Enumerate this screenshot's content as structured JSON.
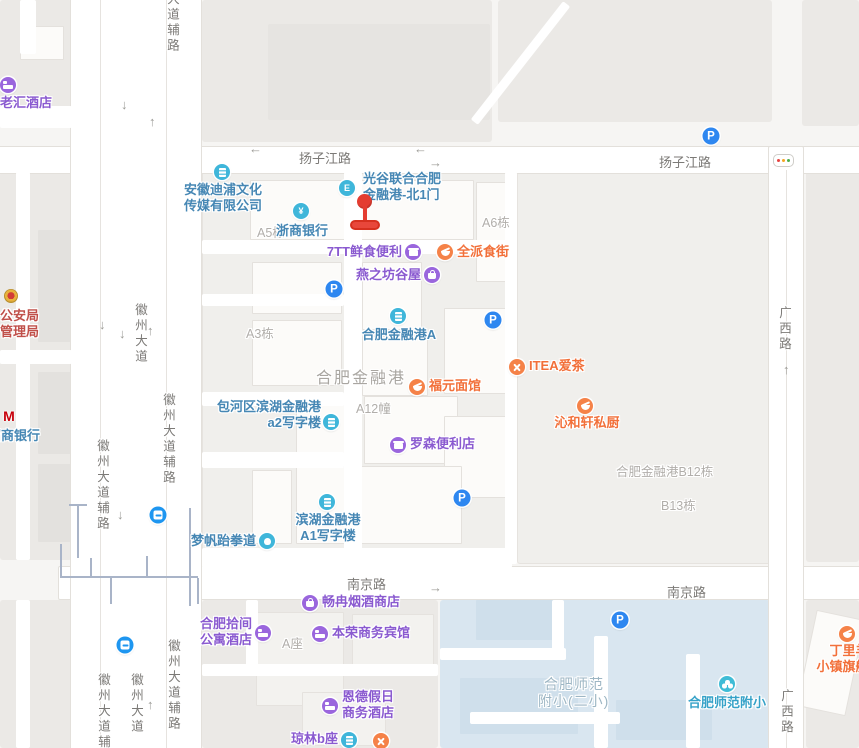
{
  "map": {
    "selected_poi": "光谷联合合肥金融港-北1门",
    "colors": {
      "land": "#f6f5f3",
      "block": "#ebe9e6",
      "campus": "#f0efec",
      "school_area": "#d9e6f0",
      "road": "#ffffff",
      "poi_purple": "#8a5ad0",
      "poi_orange": "#f2703a",
      "poi_blue": "#4687b4",
      "poi_edu": "#36a2c8",
      "parking_blue": "#2e87f0",
      "transit_blue": "#1e96f0",
      "marker_red": "#e43d31",
      "police_red": "#c0504a"
    },
    "road_labels": [
      {
        "text": "扬子江路",
        "x": 299,
        "y": 148,
        "v": false
      },
      {
        "text": "扬子江路",
        "x": 659,
        "y": 152,
        "v": false
      },
      {
        "text": "南京路",
        "x": 347,
        "y": 574,
        "v": false
      },
      {
        "text": "南京路",
        "x": 667,
        "y": 582,
        "v": false
      },
      {
        "text": "大道辅路",
        "x": 163,
        "y": -8,
        "v": true
      },
      {
        "text": "徽州大道",
        "x": 131,
        "y": 303,
        "v": true
      },
      {
        "text": "徽州大道辅路",
        "x": 159,
        "y": 393,
        "v": true
      },
      {
        "text": "徽州大道辅路",
        "x": 93,
        "y": 439,
        "v": true
      },
      {
        "text": "徽州大道辅路",
        "x": 164,
        "y": 639,
        "v": true
      },
      {
        "text": "徽州大道",
        "x": 127,
        "y": 673,
        "v": true
      },
      {
        "text": "徽州大道辅路",
        "x": 94,
        "y": 673,
        "v": true
      },
      {
        "text": "广西路",
        "x": 775,
        "y": 306,
        "v": true
      },
      {
        "text": "广西路",
        "x": 777,
        "y": 689,
        "v": true
      }
    ],
    "area_labels": [
      {
        "text": "A5栋",
        "x": 257,
        "y": 222,
        "cls": ""
      },
      {
        "text": "A6栋",
        "x": 482,
        "y": 212,
        "cls": ""
      },
      {
        "text": "A3栋",
        "x": 246,
        "y": 323,
        "cls": ""
      },
      {
        "text": "合肥金融港",
        "x": 316,
        "y": 364,
        "cls": "big"
      },
      {
        "text": "A12幢",
        "x": 356,
        "y": 398,
        "cls": ""
      },
      {
        "text": "合肥金融港B12栋",
        "x": 616,
        "y": 461,
        "cls": ""
      },
      {
        "text": "B13栋",
        "x": 661,
        "y": 495,
        "cls": ""
      },
      {
        "text": "A座",
        "x": 282,
        "y": 633,
        "cls": ""
      },
      {
        "text": "合肥师范",
        "x": 544,
        "y": 674,
        "cls": "edu"
      },
      {
        "text": "附小(二小)",
        "x": 538,
        "y": 691,
        "cls": "edu"
      }
    ],
    "pois": [
      {
        "lines": [
          "老汇酒店"
        ],
        "cat": "purple",
        "icon": "hotel-icon",
        "ix": 8,
        "iy": 85,
        "lx": 26,
        "ly": 95,
        "align": "c"
      },
      {
        "lines": [
          "安徽迪浦文化",
          "传媒有限公司"
        ],
        "cat": "blue",
        "icon": "company-building-icon",
        "ix": 222,
        "iy": 172,
        "lx": 223,
        "ly": 182,
        "align": "c"
      },
      {
        "lines": [
          "浙商银行"
        ],
        "cat": "blue",
        "icon": "bank-yuan-icon",
        "ix": 301,
        "iy": 211,
        "lx": 302,
        "ly": 223,
        "align": "c"
      },
      {
        "lines": [
          "光谷联合合肥",
          "金融港-北1门"
        ],
        "cat": "blue",
        "icon": "gate-icon",
        "ix": 347,
        "iy": 188,
        "lx": 363,
        "ly": 171,
        "align": "l"
      },
      {
        "lines": [
          "7TT鲜食便利"
        ],
        "cat": "purple",
        "icon": "convenience-store-icon",
        "ix": 413,
        "iy": 252,
        "lx": 402,
        "ly": 244,
        "align": "r"
      },
      {
        "lines": [
          "全派食街"
        ],
        "cat": "orange",
        "icon": "food-street-icon",
        "ix": 445,
        "iy": 252,
        "lx": 457,
        "ly": 244,
        "align": "l"
      },
      {
        "lines": [
          "燕之坊谷屋"
        ],
        "cat": "purple",
        "icon": "shopping-bag-icon",
        "ix": 432,
        "iy": 275,
        "lx": 421,
        "ly": 267,
        "align": "r"
      },
      {
        "lines": [
          "合肥金融港A"
        ],
        "cat": "blue",
        "icon": "building-icon",
        "ix": 398,
        "iy": 316,
        "lx": 399,
        "ly": 327,
        "align": "c"
      },
      {
        "lines": [
          "包河区滨湖金融港",
          "a2写字楼"
        ],
        "cat": "blue",
        "icon": "building-icon",
        "ix": 331,
        "iy": 422,
        "lx": 321,
        "ly": 399,
        "align": "r"
      },
      {
        "lines": [
          "罗森便利店"
        ],
        "cat": "purple",
        "icon": "convenience-store-icon",
        "ix": 398,
        "iy": 445,
        "lx": 410,
        "ly": 436,
        "align": "l"
      },
      {
        "lines": [
          "福元面馆"
        ],
        "cat": "orange",
        "icon": "restaurant-icon",
        "ix": 417,
        "iy": 387,
        "lx": 429,
        "ly": 378,
        "align": "l"
      },
      {
        "lines": [
          "ITEA爱茶"
        ],
        "cat": "orange",
        "icon": "utensils-icon",
        "ix": 517,
        "iy": 367,
        "lx": 529,
        "ly": 358,
        "align": "l"
      },
      {
        "lines": [
          "沁和轩私厨"
        ],
        "cat": "orange",
        "icon": "restaurant-icon",
        "ix": 585,
        "iy": 406,
        "lx": 587,
        "ly": 415,
        "align": "c"
      },
      {
        "lines": [
          "滨湖金融港",
          "A1写字楼"
        ],
        "cat": "blue",
        "icon": "building-icon",
        "ix": 327,
        "iy": 502,
        "lx": 328,
        "ly": 512,
        "align": "c"
      },
      {
        "lines": [
          "梦帆跆拳道"
        ],
        "cat": "blue",
        "icon": "taekwondo-icon",
        "ix": 267,
        "iy": 541,
        "lx": 256,
        "ly": 533,
        "align": "r"
      },
      {
        "lines": [
          "畅冉烟酒商店"
        ],
        "cat": "purple",
        "icon": "liquor-store-icon",
        "ix": 310,
        "iy": 603,
        "lx": 322,
        "ly": 594,
        "align": "l"
      },
      {
        "lines": [
          "合肥拾间",
          "公寓酒店"
        ],
        "cat": "purple",
        "icon": "hotel-icon",
        "ix": 263,
        "iy": 633,
        "lx": 252,
        "ly": 616,
        "align": "r"
      },
      {
        "lines": [
          "本荣商务宾馆"
        ],
        "cat": "purple",
        "icon": "hotel-icon",
        "ix": 320,
        "iy": 634,
        "lx": 332,
        "ly": 625,
        "align": "l"
      },
      {
        "lines": [
          "恩德假日",
          "商务酒店"
        ],
        "cat": "purple",
        "icon": "hotel-icon",
        "ix": 330,
        "iy": 706,
        "lx": 342,
        "ly": 689,
        "align": "l"
      },
      {
        "lines": [
          "琼林b座"
        ],
        "cat": "mixed",
        "icon": "building-icon",
        "ix": 349,
        "iy": 740,
        "lx": 338,
        "ly": 731,
        "align": "r"
      },
      {
        "lines": [],
        "cat": "orange",
        "icon": "utensils-icon",
        "ix": 381,
        "iy": 741,
        "lx": 0,
        "ly": 0,
        "align": "l"
      },
      {
        "lines": [
          "合肥师范附小"
        ],
        "cat": "edu",
        "icon": "school-icon",
        "ix": 727,
        "iy": 684,
        "lx": 727,
        "ly": 695,
        "align": "c"
      },
      {
        "lines": [
          "丁里羊",
          "小镇旗舰店"
        ],
        "cat": "orange",
        "icon": "restaurant-icon",
        "ix": 847,
        "iy": 634,
        "lx": 849,
        "ly": 643,
        "align": "c"
      },
      {
        "lines": [
          "公安局",
          "管理局"
        ],
        "cat": "police",
        "icon": "police-badge-icon",
        "ix": 11,
        "iy": 296,
        "lx": 0,
        "ly": 308,
        "align": "l"
      },
      {
        "lines": [
          "招商银行"
        ],
        "cat": "bankred",
        "icon": "cmb-bank-icon",
        "ix": 9,
        "iy": 416,
        "lx": -12,
        "ly": 428,
        "align": "l"
      }
    ],
    "parking_label": "P",
    "parking": [
      {
        "x": 711,
        "y": 136
      },
      {
        "x": 334,
        "y": 289
      },
      {
        "x": 493,
        "y": 320
      },
      {
        "x": 462,
        "y": 498
      },
      {
        "x": 620,
        "y": 620
      }
    ],
    "transit_stations": [
      {
        "x": 158,
        "y": 515
      },
      {
        "x": 125,
        "y": 645
      }
    ],
    "arrows": [
      {
        "g": "↓",
        "x": 121,
        "y": 97
      },
      {
        "g": "↑",
        "x": 149,
        "y": 114
      },
      {
        "g": "←",
        "x": 249,
        "y": 141
      },
      {
        "g": "←",
        "x": 414,
        "y": 141
      },
      {
        "g": "→",
        "x": 429,
        "y": 155
      },
      {
        "g": "↓",
        "x": 119,
        "y": 326
      },
      {
        "g": "↑",
        "x": 147,
        "y": 323
      },
      {
        "g": "↓",
        "x": 99,
        "y": 317
      },
      {
        "g": "↓",
        "x": 117,
        "y": 507
      },
      {
        "g": "↑",
        "x": 147,
        "y": 697
      },
      {
        "g": "→",
        "x": 429,
        "y": 580
      },
      {
        "g": "↑",
        "x": 783,
        "y": 362
      }
    ],
    "traffic_light_colors": [
      "#e64340",
      "#f5a623",
      "#4cae4c"
    ]
  }
}
